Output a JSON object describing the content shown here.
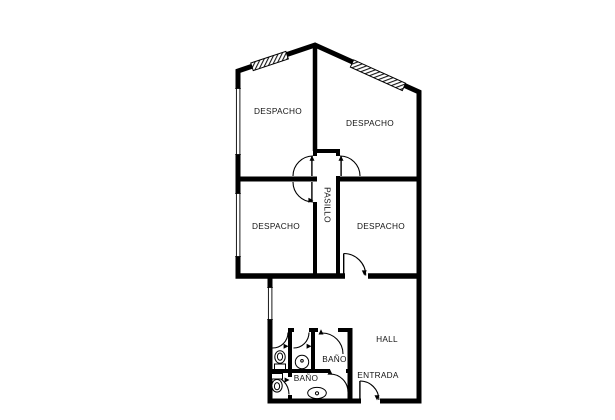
{
  "plan": {
    "colors": {
      "walls": "#000000",
      "text": "#141414",
      "background": "#ffffff"
    },
    "rooms": {
      "despacho_top_left": {
        "label": "DESPACHO"
      },
      "despacho_top_right": {
        "label": "DESPACHO"
      },
      "despacho_mid_left": {
        "label": "DESPACHO"
      },
      "despacho_mid_right": {
        "label": "DESPACHO"
      },
      "pasillo": {
        "label": "PASILLO"
      },
      "bano_upper": {
        "label": "BAÑO"
      },
      "bano_lower": {
        "label": "BAÑO"
      },
      "hall": {
        "label": "HALL"
      },
      "entrada": {
        "label": "ENTRADA"
      }
    }
  }
}
